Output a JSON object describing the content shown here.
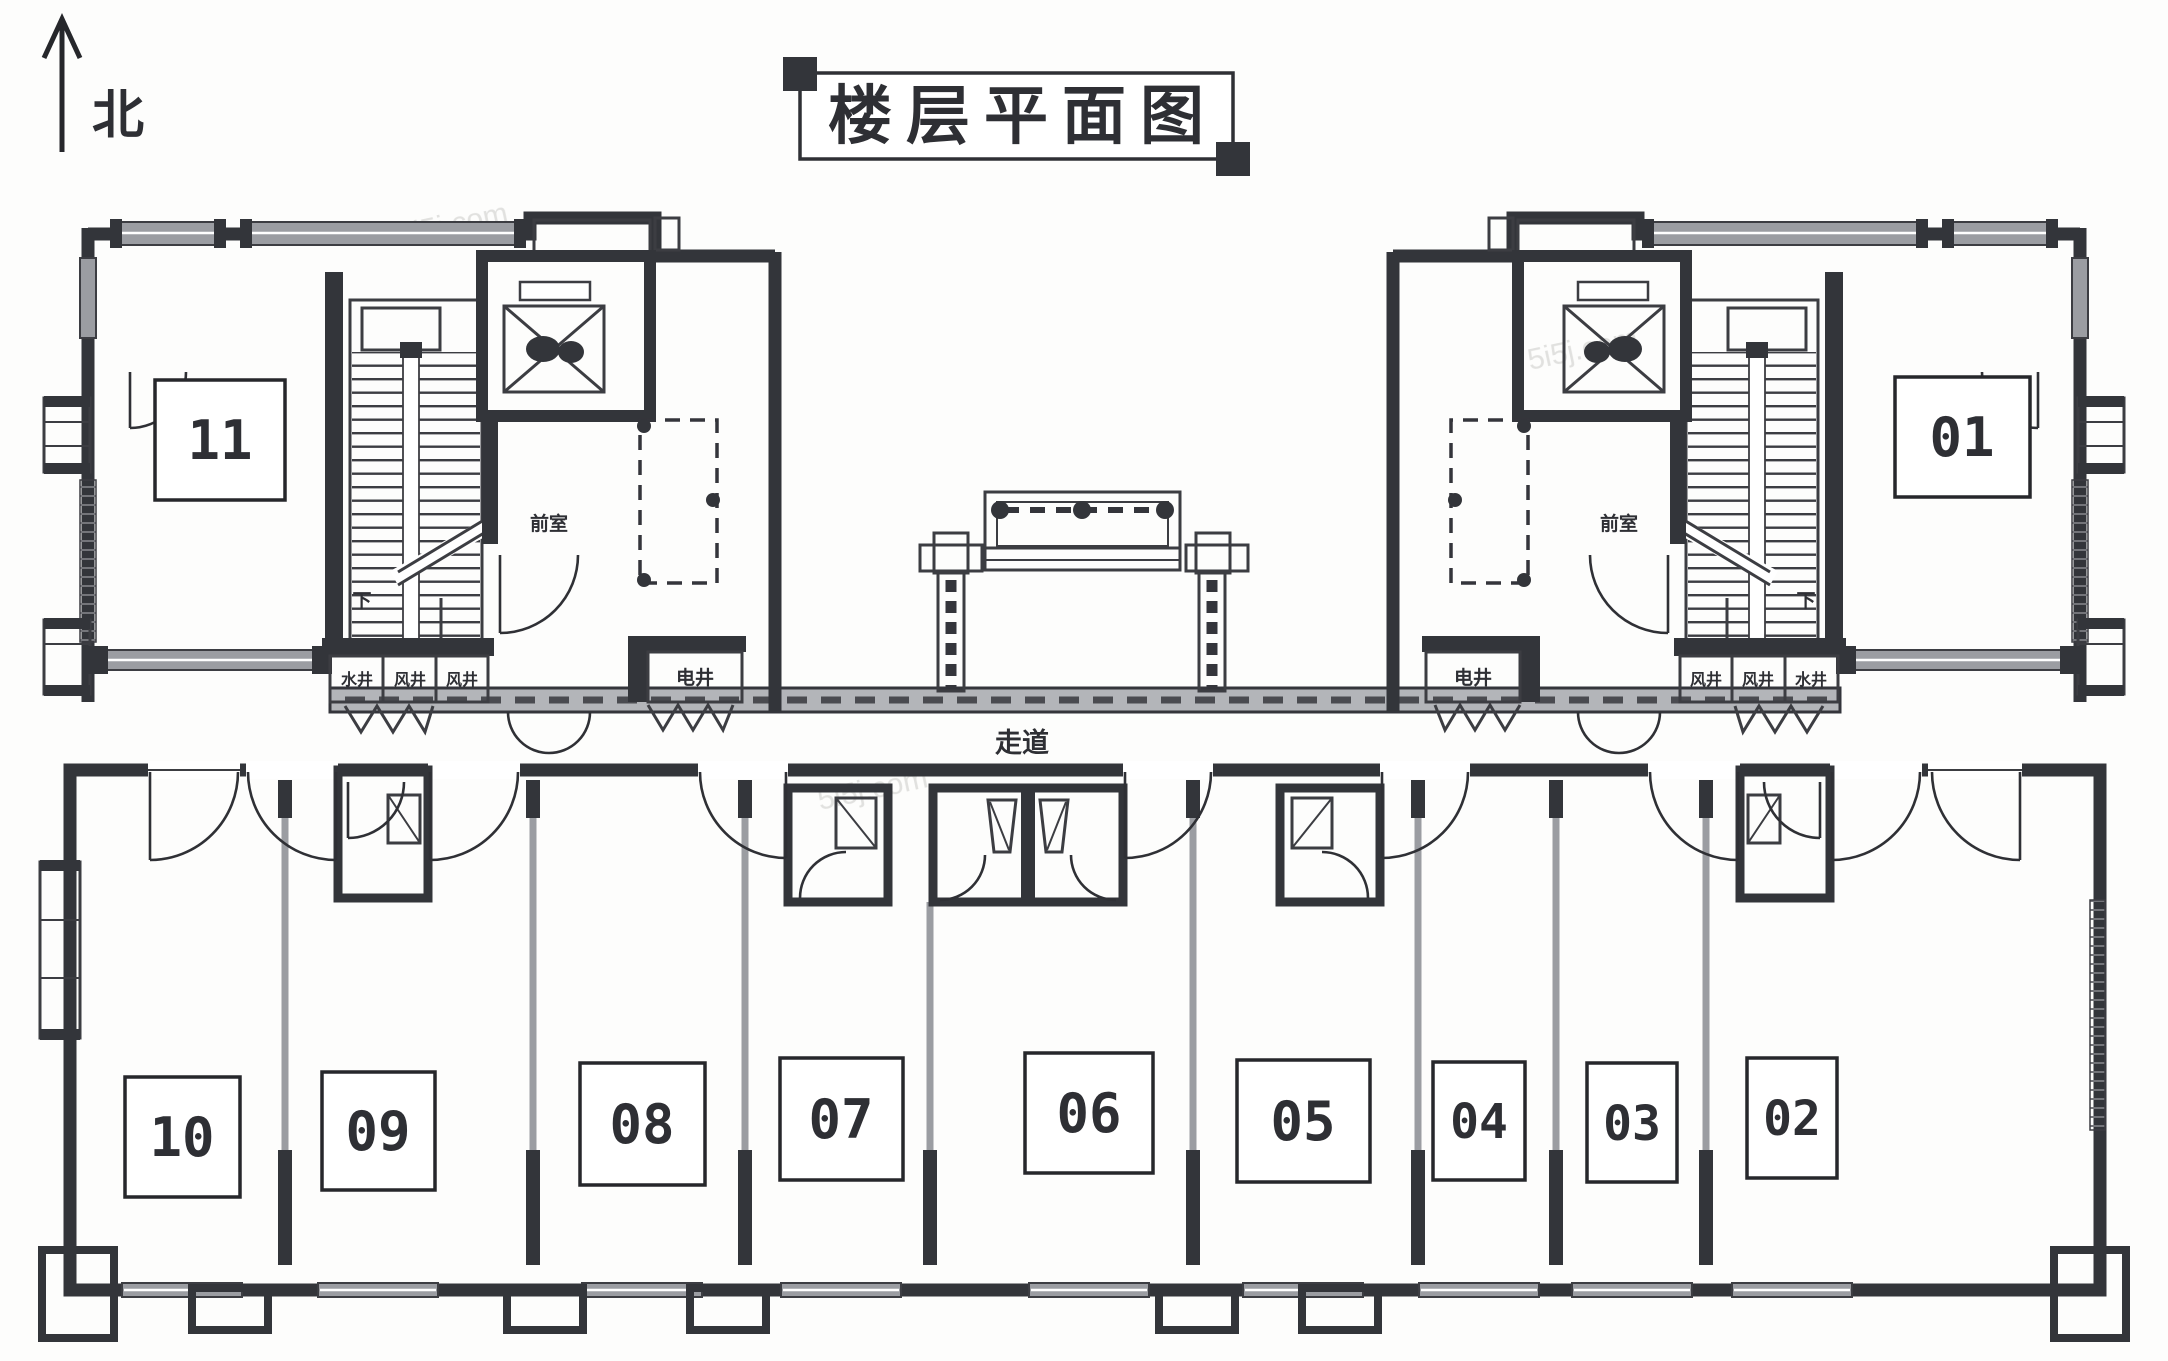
{
  "page": {
    "title": "楼层平面图",
    "north_label": "北",
    "watermark": "5i5j.com"
  },
  "floor_plan": {
    "corridor_label": "走道",
    "left_wing": {
      "stair_down_label": "下",
      "vestibule_label": "前室",
      "electrical_shaft_label": "电井",
      "shafts": [
        "水井",
        "风井",
        "风井"
      ]
    },
    "right_wing": {
      "stair_down_label": "下",
      "vestibule_label": "前室",
      "electrical_shaft_label": "电井",
      "shafts": [
        "风井",
        "风井",
        "水井"
      ]
    },
    "rooms": [
      {
        "number": "11"
      },
      {
        "number": "01"
      },
      {
        "number": "10"
      },
      {
        "number": "09"
      },
      {
        "number": "08"
      },
      {
        "number": "07"
      },
      {
        "number": "06"
      },
      {
        "number": "05"
      },
      {
        "number": "04"
      },
      {
        "number": "03"
      },
      {
        "number": "02"
      }
    ],
    "colors": {
      "wall": "#33353a",
      "window_gray": "#9b9da2",
      "room_number_red": "#a23950"
    }
  }
}
